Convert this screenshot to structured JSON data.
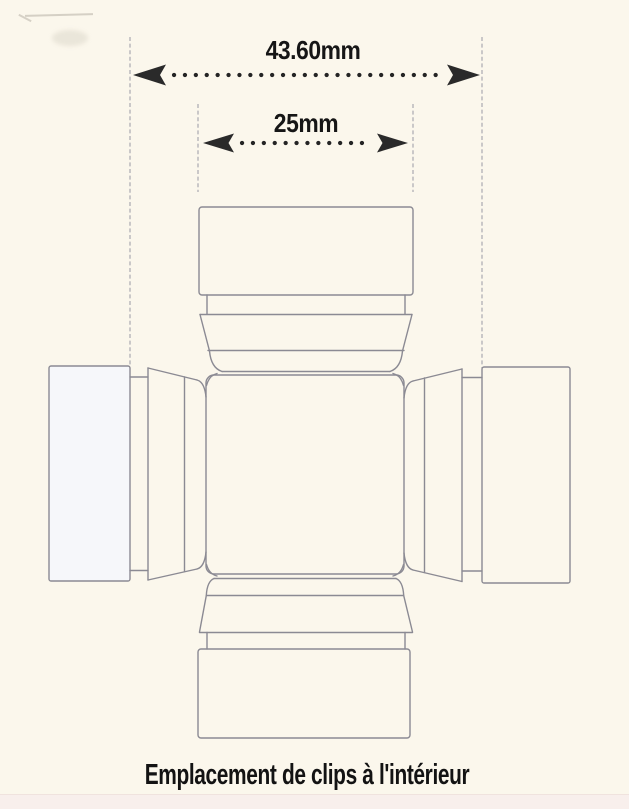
{
  "page": {
    "background_color": "#fbf7ec",
    "footer_band_color": "#f8efec"
  },
  "annotations": {
    "dim_outer": {
      "label": "43.60mm",
      "value_mm": 43.6
    },
    "dim_inner": {
      "label": "25mm",
      "value_mm": 25
    },
    "caption": "Emplacement de clips à l'intérieur"
  },
  "colors": {
    "drawing_line": "#8b8a93",
    "extension_line": "#aaa9b1",
    "dimension_ink": "#242424",
    "text_ink": "#161616",
    "background": "#fbf7ec",
    "footer_band": "#f8efec"
  }
}
